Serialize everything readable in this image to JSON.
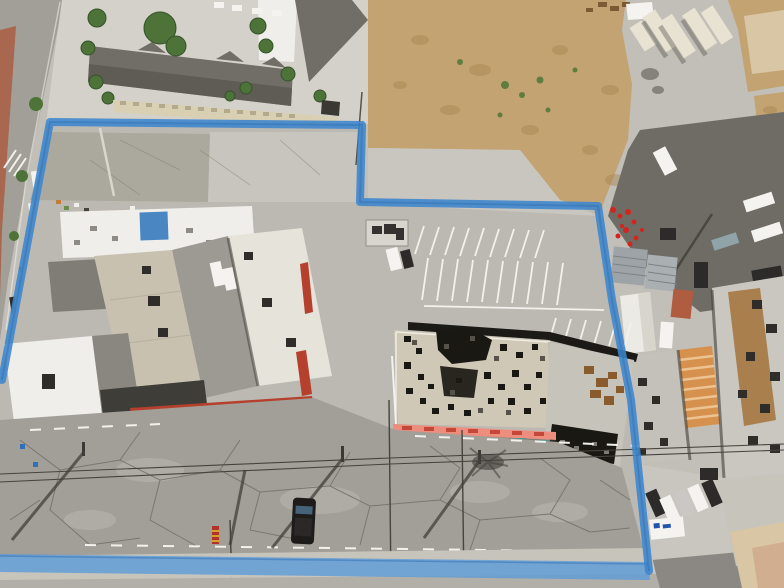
{
  "image": {
    "kind": "aerial-drone-photograph",
    "subject": "commercial property outlined with blue boundary line",
    "width": 784,
    "height": 588
  },
  "boundary": {
    "label": "property-boundary",
    "polyline": "2,380 50,122 362,125 360,202 598,206 612,300 631,400 649,571",
    "bottom_band": "0,554 648,562 650,580 0,572"
  },
  "palette": {
    "base": "#c2bfb8",
    "concrete": "#c9c6bf",
    "concreteLight": "#d4d1ca",
    "lotConcrete": "#bcb9b2",
    "lotGreen": "#a8a79a",
    "streetAsphalt": "#a29f99",
    "asphaltDark": "#8b8883",
    "asphaltRight": "#6f6c66",
    "sidewalk": "#c7c4bc",
    "sidewalkDim": "#b2afa8",
    "crack": "#7a776f",
    "dirt": "#c3a372",
    "dirtDark": "#a9854f",
    "weeds": "#5f7d3e",
    "brownDebris": "#7c5a33",
    "roofApt": "#716e68",
    "roofAptDark": "#5f5c56",
    "wallBeige": "#d9cfb3",
    "wallNotch": "#b3a98c",
    "palm": "#4d7338",
    "palmDark": "#35522a",
    "roofWhite": "#efeeea",
    "roofWhite2": "#e6e3db",
    "roofTan": "#c9c1b0",
    "roofGrayB": "#807d77",
    "roofGray": "#c4c1ba",
    "roofGray2": "#cac7c0",
    "roofBurned": "#d0c8b6",
    "burnBlack": "#1a1813",
    "burnGray": "#56524a",
    "burnRust": "#8a5c2d",
    "plywood": "#a97f4e",
    "redAwning": "#b4402d",
    "pinkAwning": "#ec8d7e",
    "pinkTick": "#c4473a",
    "blueLine": "#3c85cd",
    "blueLineDark": "#2f6fb4",
    "blueBand": "#5b9bd8",
    "blueTarp": "#4a86c2",
    "container": "#e8e2d2",
    "containerShade": "#c9c2ae",
    "shedMetal": "#9da3a6",
    "shedMetal2": "#aab0b2",
    "shedRib": "#7c8387",
    "redShed": "#b05c40",
    "tentWhite": "#eceae4",
    "tentShade": "#d8d5cd",
    "orangeAwning": "#d6914f",
    "orangeLight": "#ecc391",
    "buildingBeige": "#d9c6a4",
    "pinkWall": "#cfa98c",
    "white": "#f4f3f0",
    "silver": "#c9c8c4",
    "teal": "#4f948a",
    "tealCar": "#8fa3a8",
    "carRed": "#b33226",
    "carBlue": "#3f5f8a",
    "carDark": "#2c2b29",
    "hvac": "#2f2d2a",
    "shadow": "#413f3a",
    "shadowDark": "#3f3d38",
    "brick": "#a8674e",
    "flowerRed": "#d1251d",
    "equip": "#343231",
    "poleDark": "#3b3936",
    "wire": "#46443f",
    "stripe": "#f2f1ed"
  }
}
